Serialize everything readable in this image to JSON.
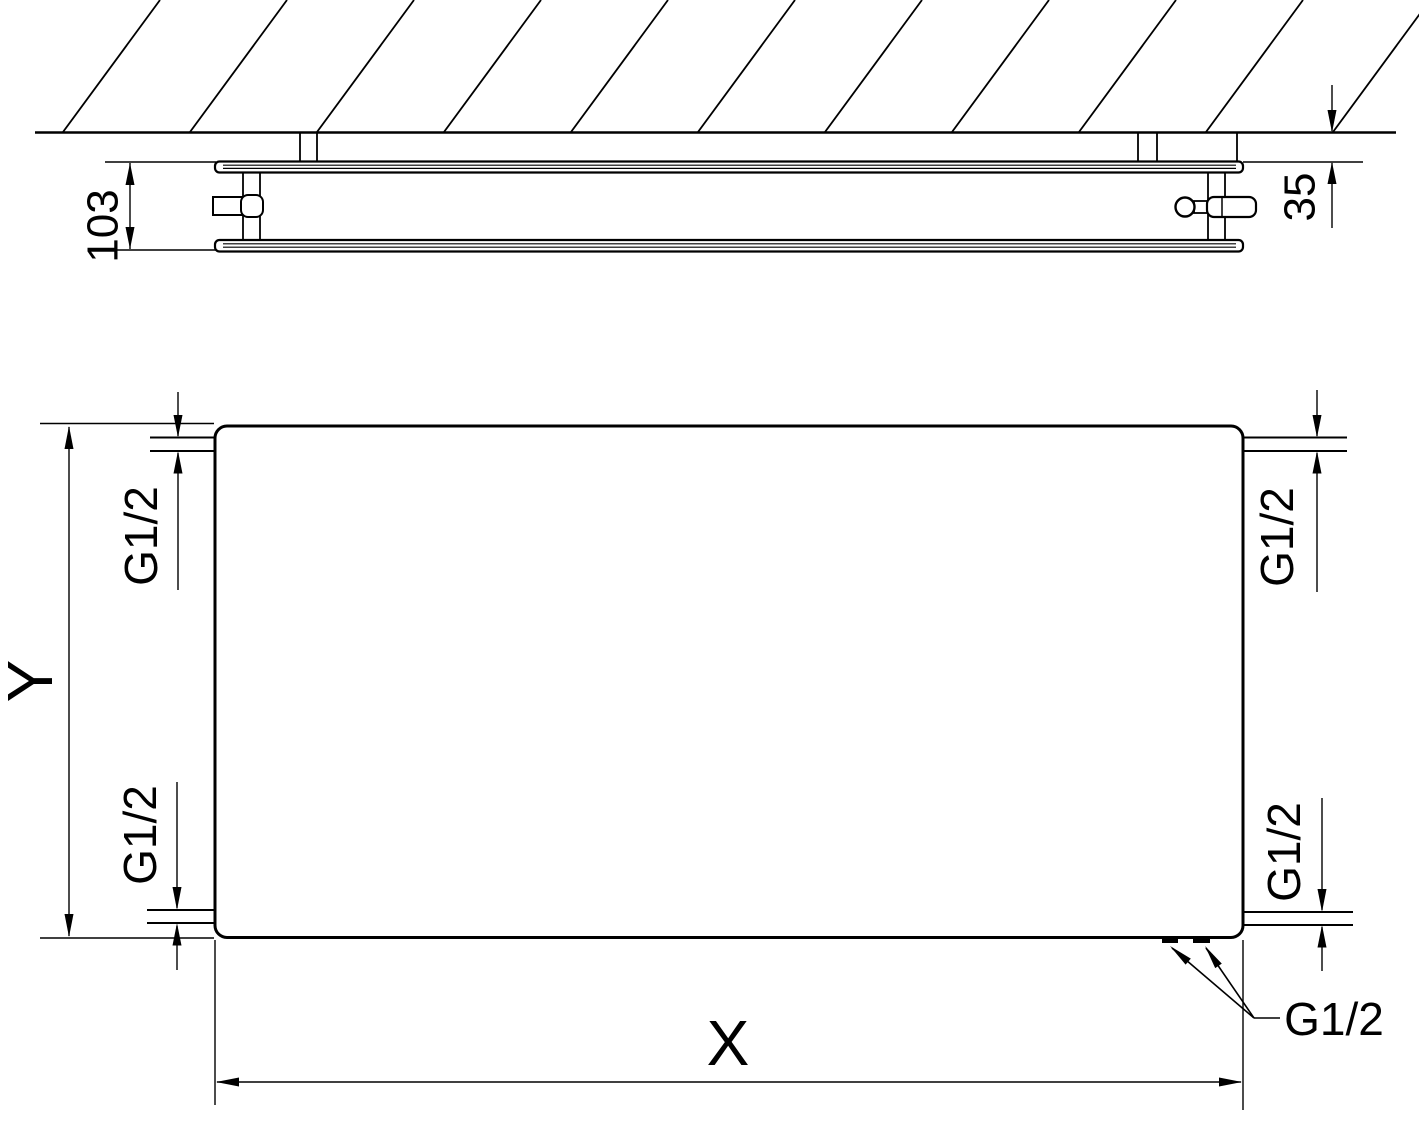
{
  "colors": {
    "line": "#000000",
    "background": "#ffffff"
  },
  "top_view": {
    "depth_dimension": "103",
    "wall_gap_dimension": "35"
  },
  "front_view": {
    "height_dimension": "Y",
    "width_dimension": "X",
    "connection_top_left": "G1/2",
    "connection_bottom_left": "G1/2",
    "connection_top_right": "G1/2",
    "connection_bottom_right": "G1/2",
    "connection_bottom": "G1/2"
  }
}
